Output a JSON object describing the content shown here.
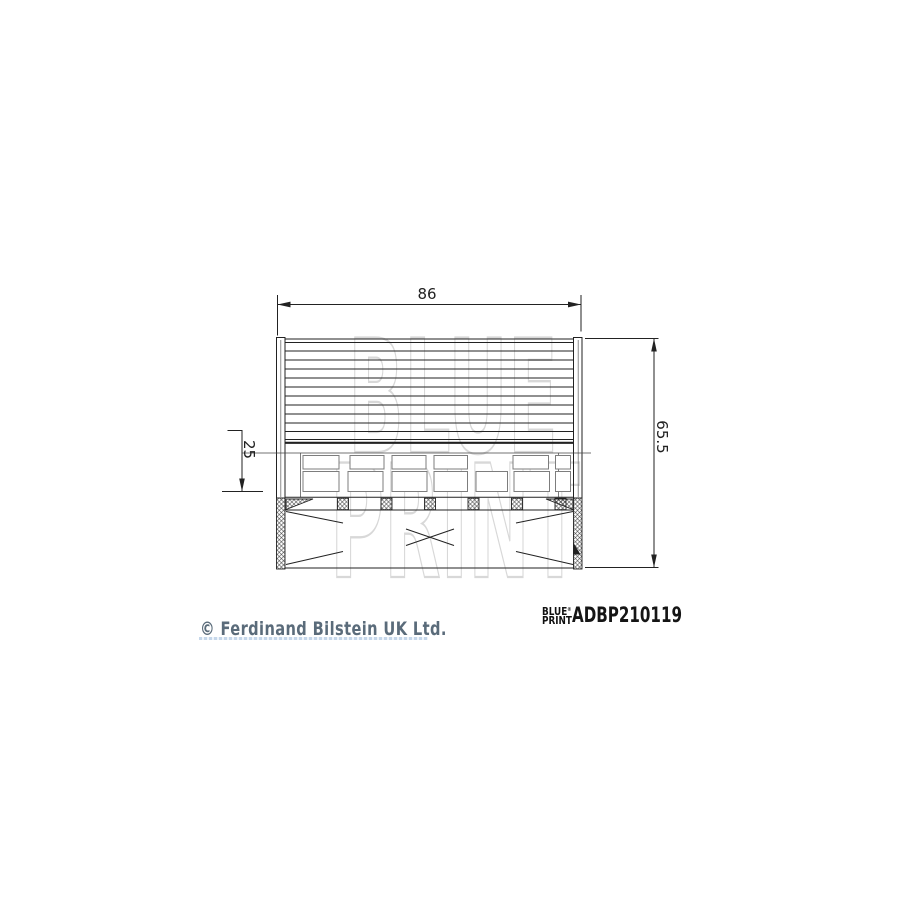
{
  "canvas": {
    "background": "#ffffff"
  },
  "watermark": {
    "line1": "BLUE",
    "line2": "PRINT",
    "color": "#d8d8d8"
  },
  "drawing": {
    "dimensions": {
      "width_label": "86",
      "height_label": "65.5",
      "inner_label": "25"
    },
    "line_color": "#222222",
    "detail_line_color": "#7d7d7d"
  },
  "footer": {
    "brand": {
      "logo_line1": "BLUE",
      "logo_line2": "PRINT",
      "registered_mark": "®",
      "color": "#111111"
    },
    "part_number": "ADBP210119",
    "copyright_text": "© Ferdinand Bilstein UK Ltd.",
    "copyright_color": "#5a6b7a"
  }
}
